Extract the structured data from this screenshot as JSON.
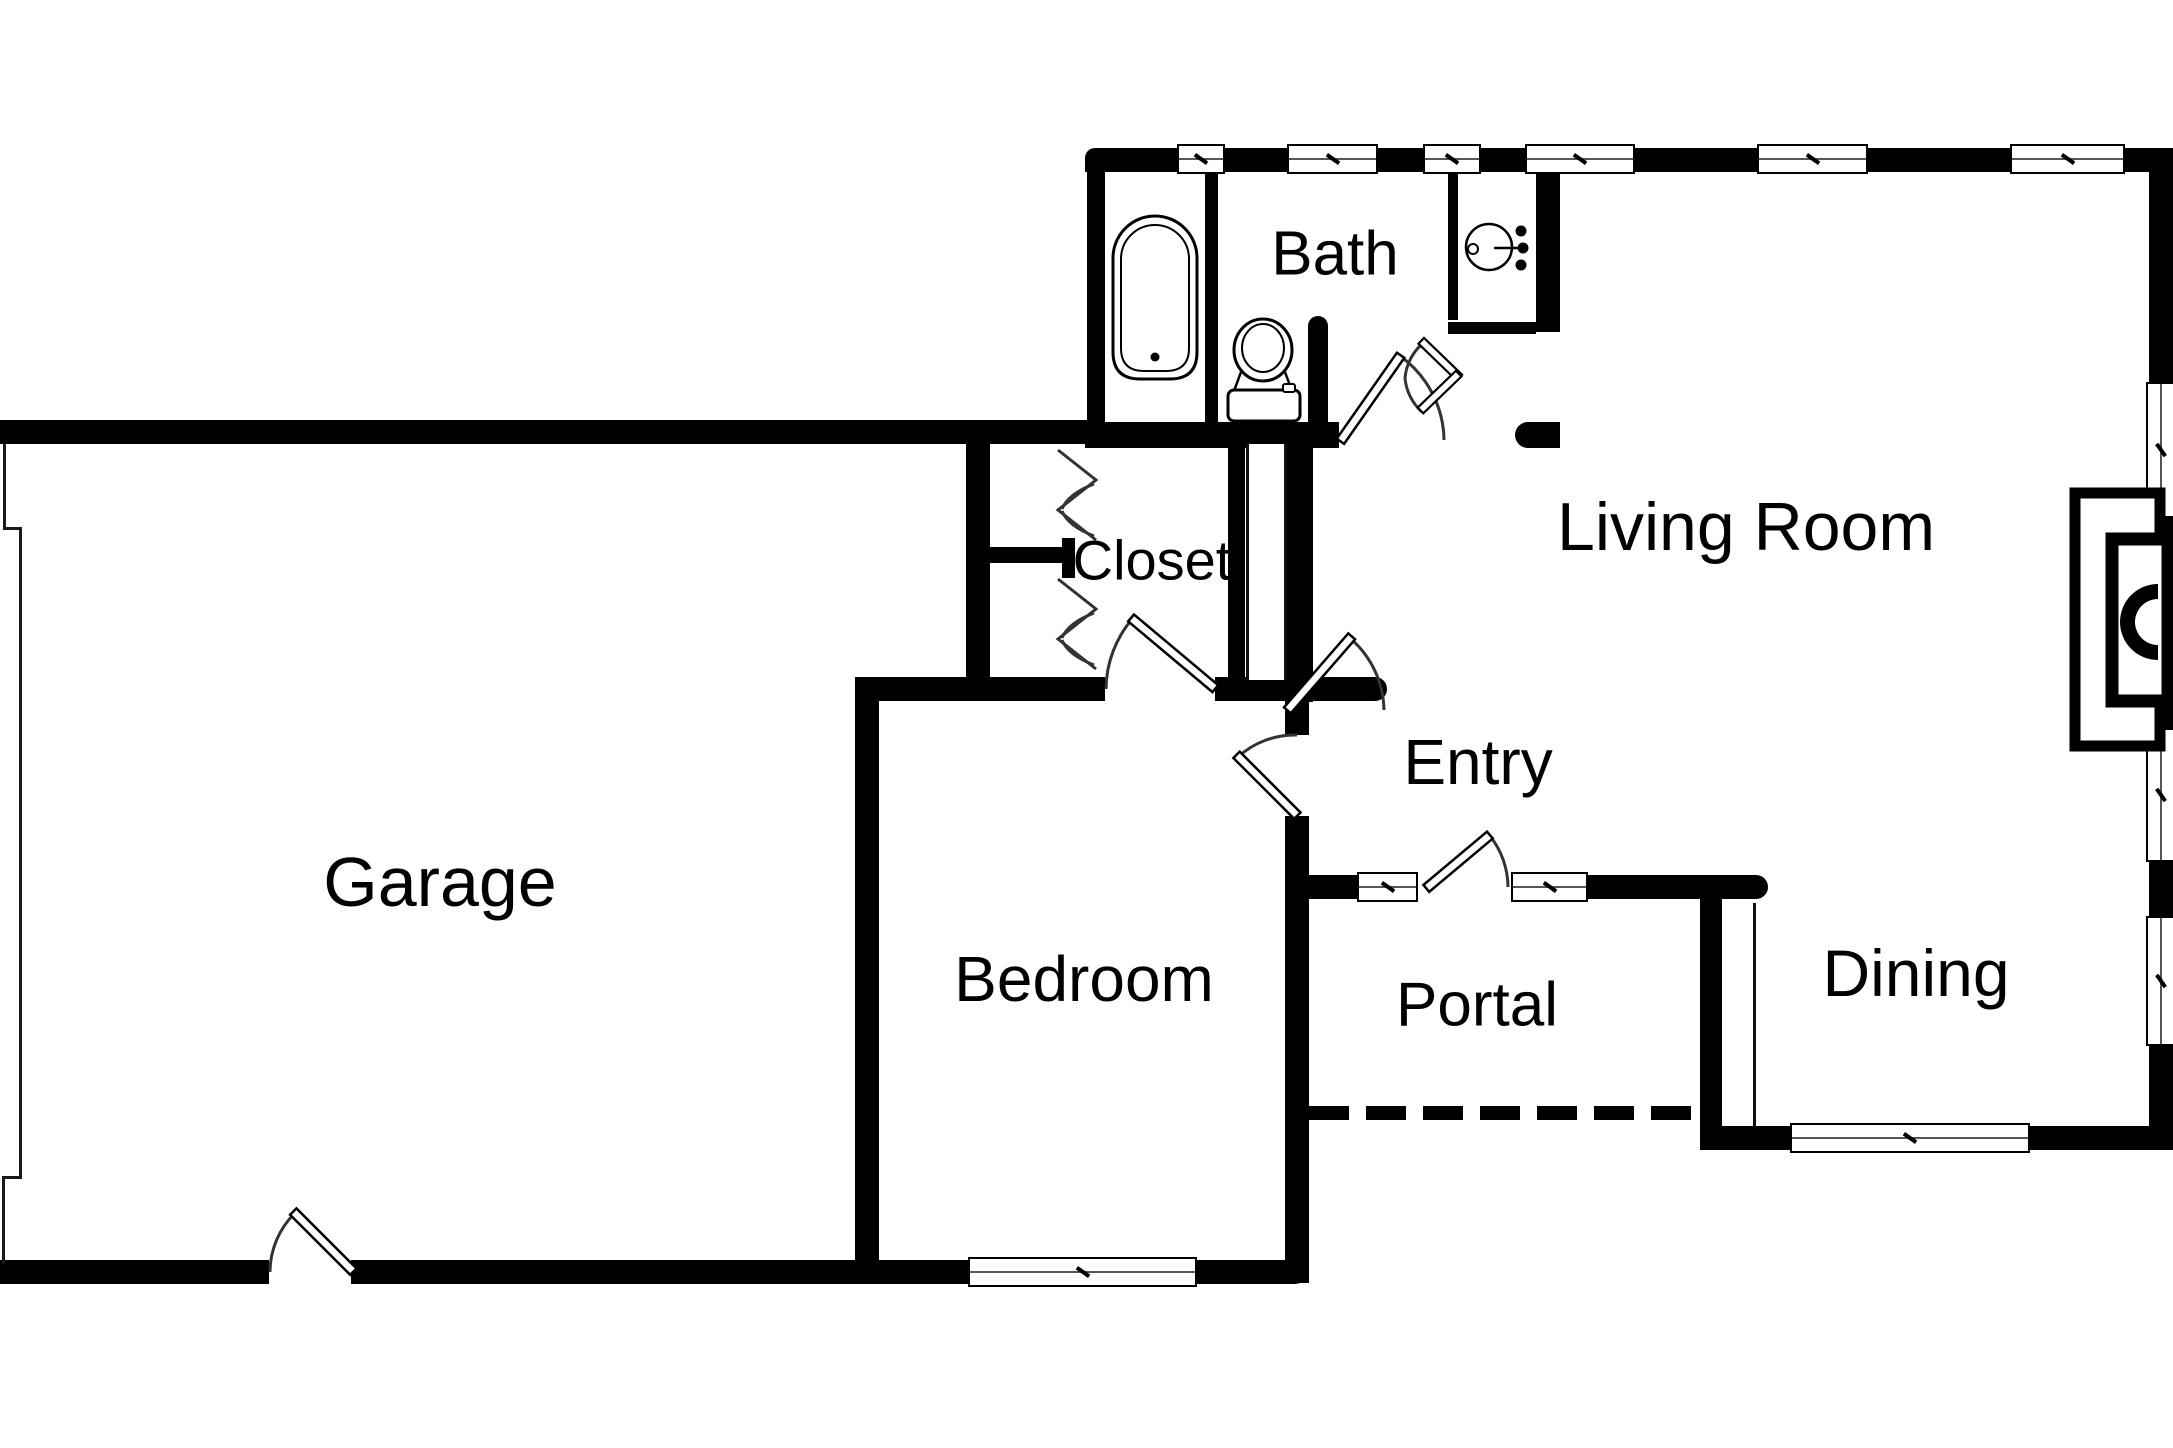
{
  "floorplan": {
    "rooms": [
      {
        "id": "garage",
        "label": "Garage"
      },
      {
        "id": "bath",
        "label": "Bath"
      },
      {
        "id": "closet",
        "label": "Closet"
      },
      {
        "id": "living-room",
        "label": "Living Room"
      },
      {
        "id": "entry",
        "label": "Entry"
      },
      {
        "id": "bedroom",
        "label": "Bedroom"
      },
      {
        "id": "portal",
        "label": "Portal"
      },
      {
        "id": "dining",
        "label": "Dining"
      }
    ],
    "fixtures": [
      "bathtub",
      "toilet",
      "sink",
      "fireplace"
    ],
    "colors": {
      "wall": "#000000",
      "background": "#ffffff",
      "text": "#000000"
    }
  }
}
